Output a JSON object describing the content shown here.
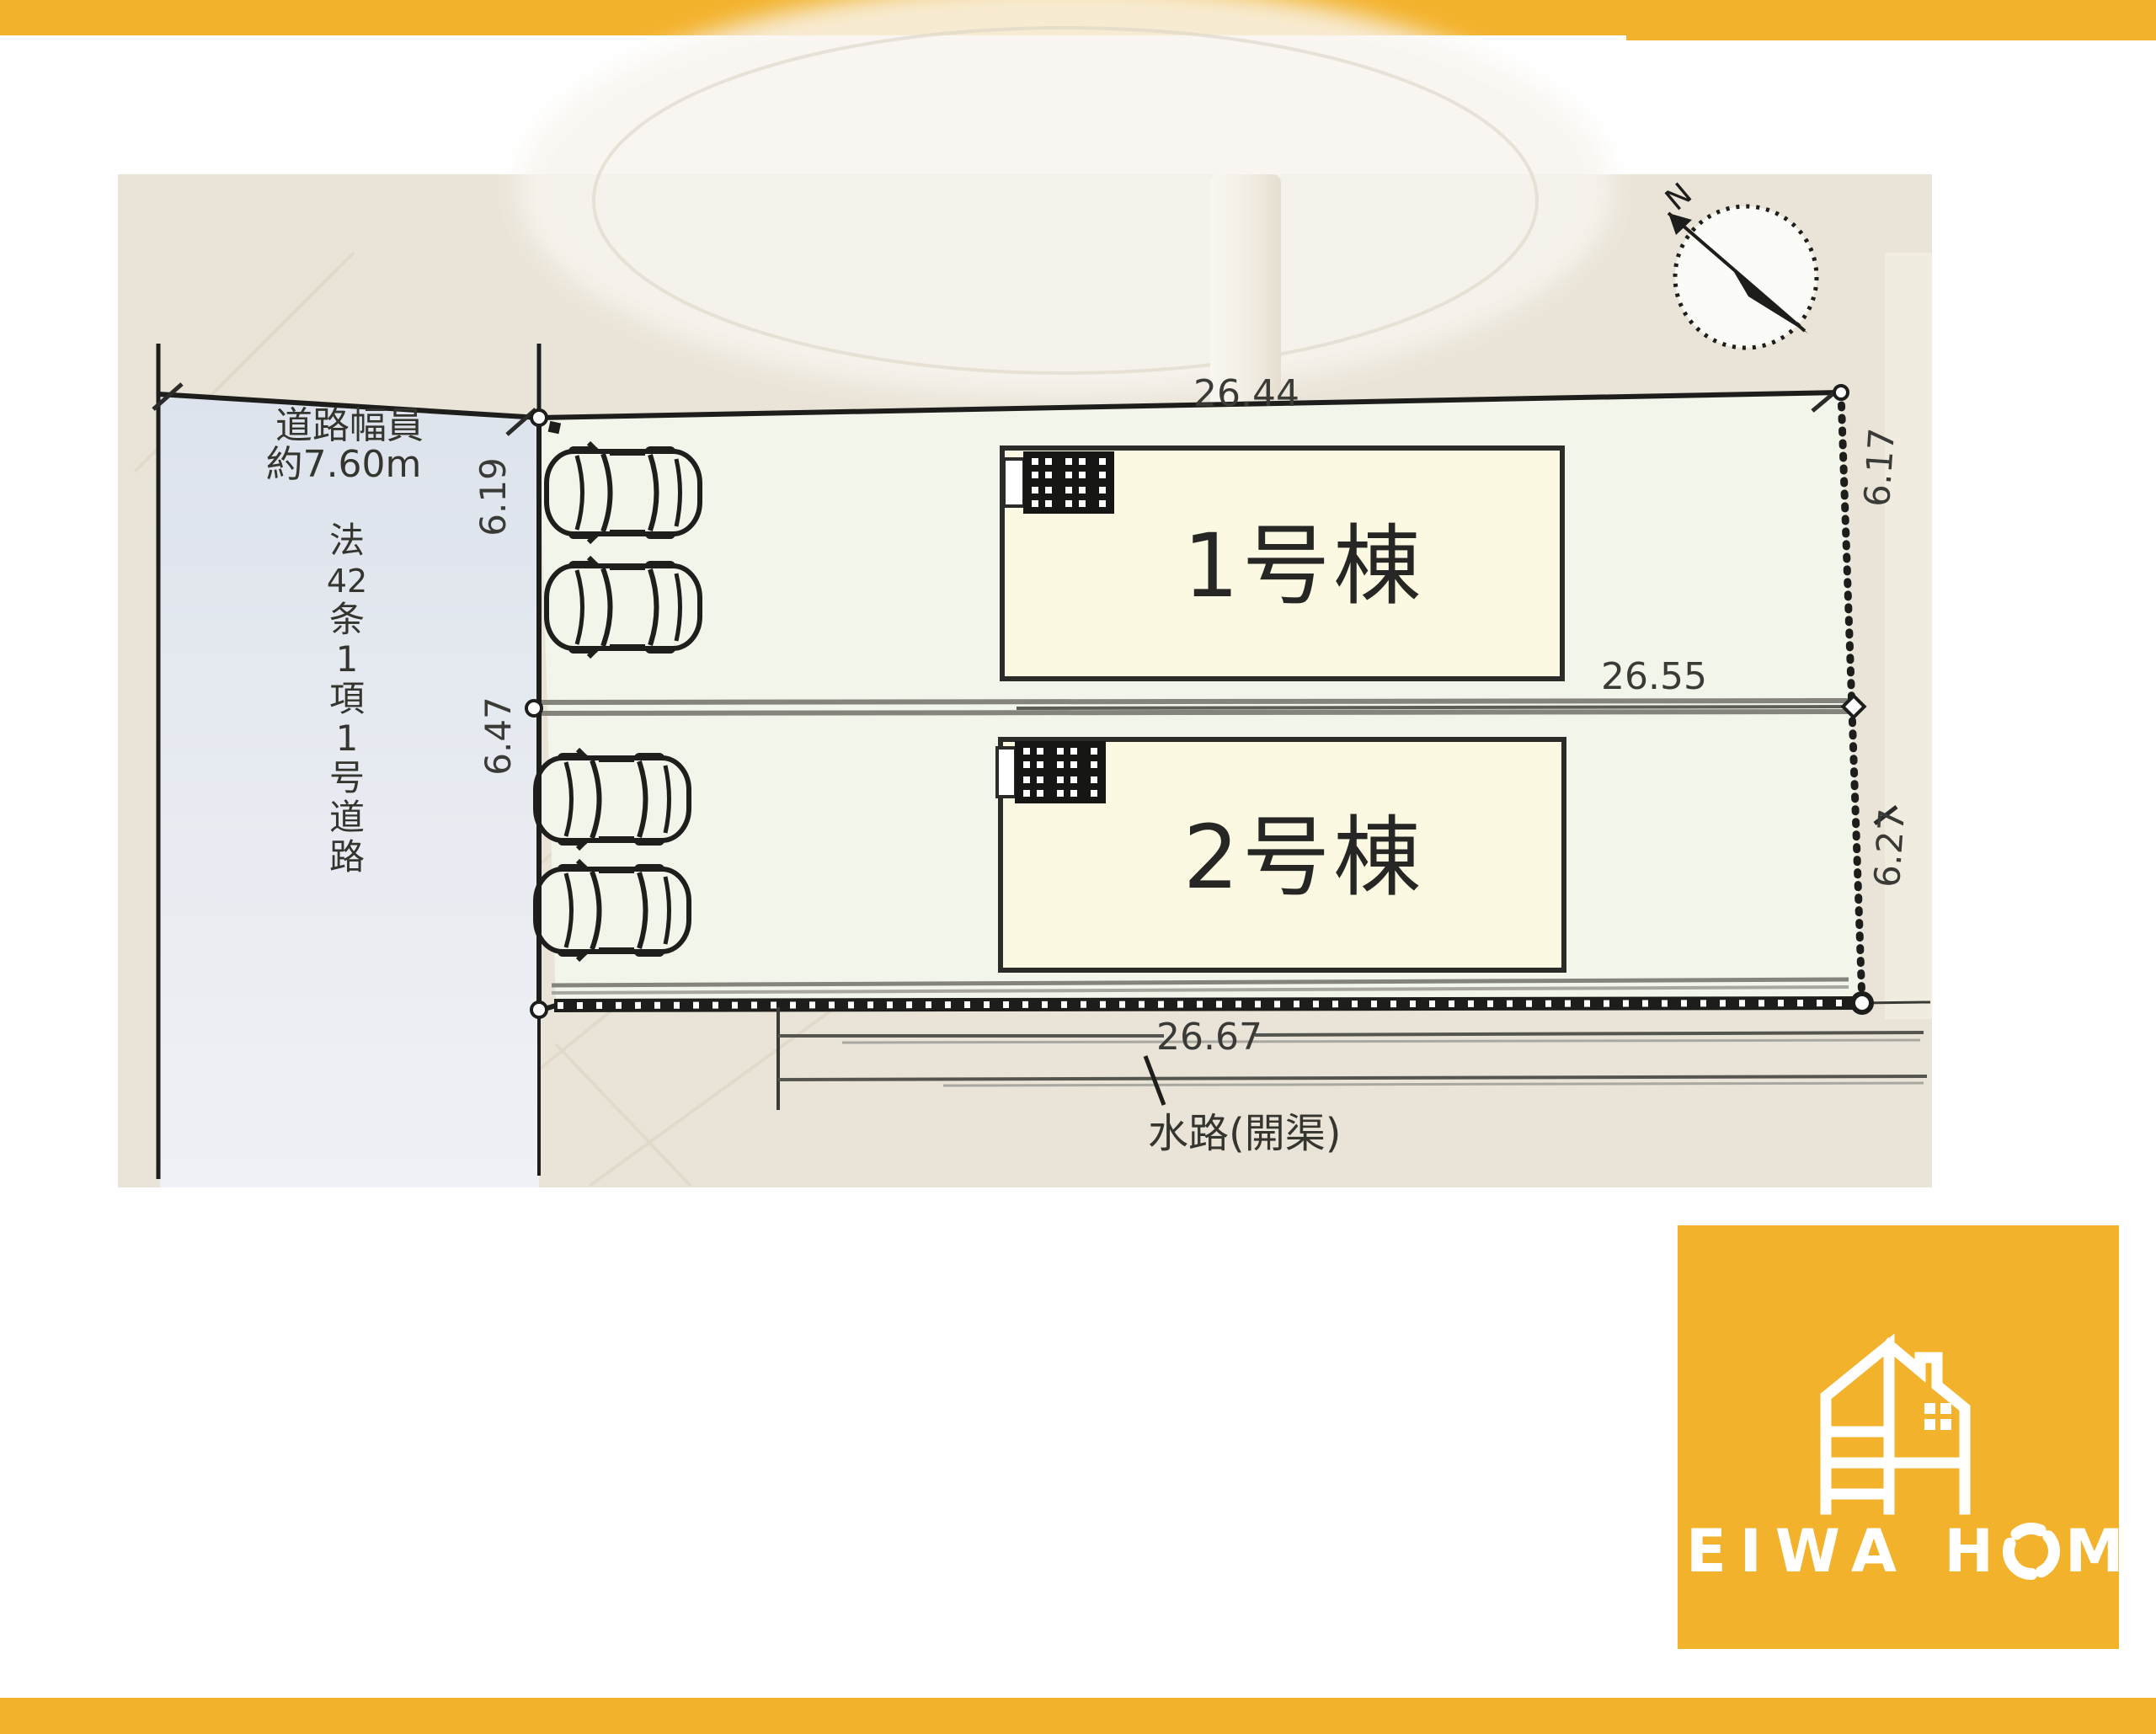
{
  "colors": {
    "accent_orange": "#F3B22C",
    "photo_beige": "#EAE4D8",
    "road_fill": "#E3E8EF",
    "plot_fill": "#F2F5E9",
    "building_fill": "#FCF9E2",
    "line_dark": "#1D1D1B",
    "wall_gray": "#84847D"
  },
  "plan": {
    "compass_north_label": "N",
    "road_width_label": [
      "道路幅員",
      "約7.60m"
    ],
    "road_class_chars": [
      "法",
      "42",
      "条",
      "1",
      "項",
      "1",
      "号",
      "道",
      "路"
    ],
    "dimensions": {
      "top": "26.44",
      "middle": "26.55",
      "bottom": "26.67",
      "left_upper": "6.19",
      "left_lower": "6.47",
      "right_upper": "6.17",
      "right_lower": "6.27"
    },
    "building1_label": "1号棟",
    "building2_label": "2号棟",
    "water_label": "水路(開渠)"
  },
  "logo": {
    "brand_pre": "EIWA H",
    "brand_o": "O",
    "brand_post": "ME"
  }
}
